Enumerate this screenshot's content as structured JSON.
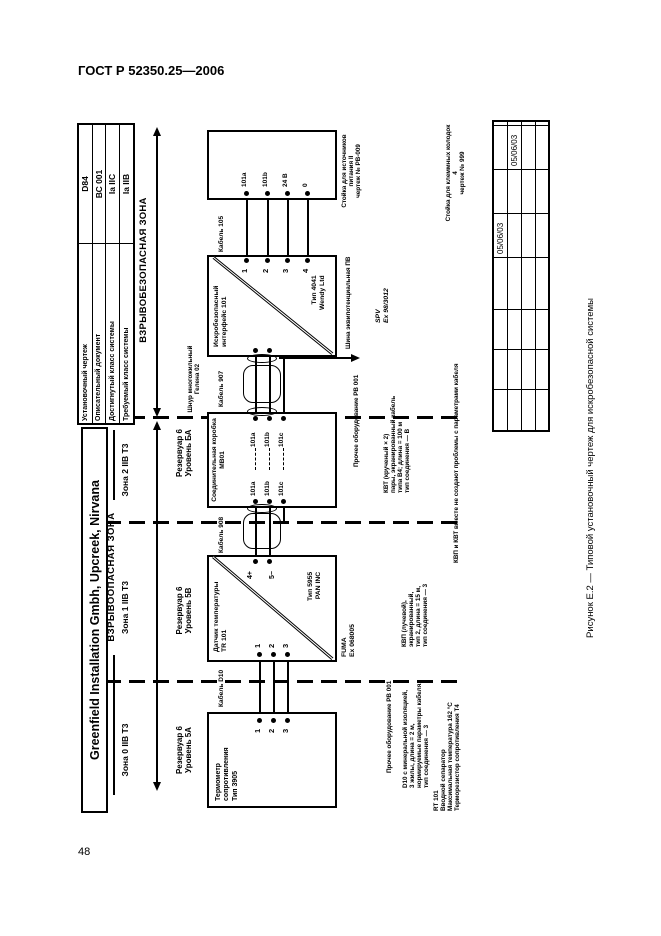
{
  "page": {
    "doc_header": "ГОСТ Р 52350.25—2006",
    "page_number": "48",
    "caption": "Рисунок Е.2 — Типовой установочный чертеж для искробезопасной системы"
  },
  "company": "Greenfield Installation Gmbh, Upcreek, Nirvana",
  "info_table": {
    "rows": [
      {
        "label": "Установочный чертеж",
        "value": "D84"
      },
      {
        "label": "Описательный документ",
        "value": "ВС 001"
      },
      {
        "label": "Достигнутый класс системы",
        "value": "Ia IIC"
      },
      {
        "label": "Требуемый класс системы",
        "value": "Ia IIB"
      }
    ]
  },
  "zones": {
    "hazard_label": "ВЗРЫВООПАСНАЯ ЗОНА",
    "safe_label": "ВЗРЫВОБЕЗОПАСНАЯ ЗОНА",
    "zone0": "Зона 0 IIB T3",
    "zone1": "Зона 1 IIB T3",
    "zone2": "Зона 2 IIB T3"
  },
  "reservoirs": {
    "r0": [
      "Резервуар 6",
      "Уровень 5А"
    ],
    "r1": [
      "Резервуар 6",
      "Уровень 5В"
    ],
    "r2": [
      "Резервуар 6",
      "Уровень БА"
    ]
  },
  "rtd": {
    "lines": [
      "Термометр",
      "сопротивления",
      "Тип 3905"
    ],
    "terminals": [
      "1",
      "2",
      "3"
    ]
  },
  "tr101": {
    "name": [
      "Датчик температуры",
      "TR 101"
    ],
    "type": [
      "Тип 5955",
      "PAN INC"
    ],
    "cert": [
      "FUMA",
      "Ex 068005"
    ],
    "left_terminals": [
      "1",
      "2",
      "3"
    ],
    "right_terminals": [
      "4+",
      "5−"
    ]
  },
  "mb01": {
    "name": [
      "Соединительная коробка",
      "МВ01"
    ],
    "left_terminals": [
      "101a",
      "101b",
      "101c"
    ],
    "right_terminals": [
      "101a",
      "101b",
      "101c"
    ]
  },
  "iface": {
    "name": [
      "Искробезопасный",
      "интерфейс 101"
    ],
    "type": [
      "Тип 4041",
      "Wendy Ltd"
    ],
    "cert": [
      "SPV",
      "Ex 98/3012"
    ],
    "terminals": [
      "1",
      "2",
      "3",
      "4"
    ],
    "ground_label": "Шина эквипотенциальная ПВ"
  },
  "rack": {
    "terminals": [
      "101a",
      "101b",
      "24 В",
      "0"
    ],
    "label": [
      "Стойка для источников",
      "питания II",
      "чертеж № РВ-009"
    ],
    "far_label": [
      "Стойка для клеммных колодок 4",
      "чертеж № 999"
    ]
  },
  "cables": {
    "d10": "Кабель D10",
    "c908": "Кабель 908",
    "c907": "Кабель 907",
    "c105": "Кабель 105",
    "multicore": [
      "Шнур многожильный",
      "Гелена 02"
    ]
  },
  "notes": {
    "kvp": [
      "КВП (лучевой),",
      "экранированный,",
      "тип 2, длина = 15 м,",
      "тип соединения — 3"
    ],
    "kvt": [
      "КВТ (крученый × 2)",
      "пары, экранированный кабель",
      "типа В4; длина = 100 м",
      "тип соединения — В"
    ],
    "combined": "КВП и КВТ вместе не создают проблемы с параметрами кабеля",
    "d10": [
      "D10 с минеральной изоляцией,",
      "3 жилы, длина = 2 м,",
      "нормируемые параметры кабеля,",
      "тип соединения — 3"
    ],
    "other1": "Прочее оборудование РВ 001",
    "other2": "Прочее оборудование РВ 001",
    "rt101": [
      "RT 101",
      "Вводной сепаратор",
      "Максимальная температура 162 °С",
      "Терморезистор сопротивления Т4"
    ]
  },
  "titleblock": {
    "date1": "05/06/03",
    "date2": "05/06/03"
  }
}
